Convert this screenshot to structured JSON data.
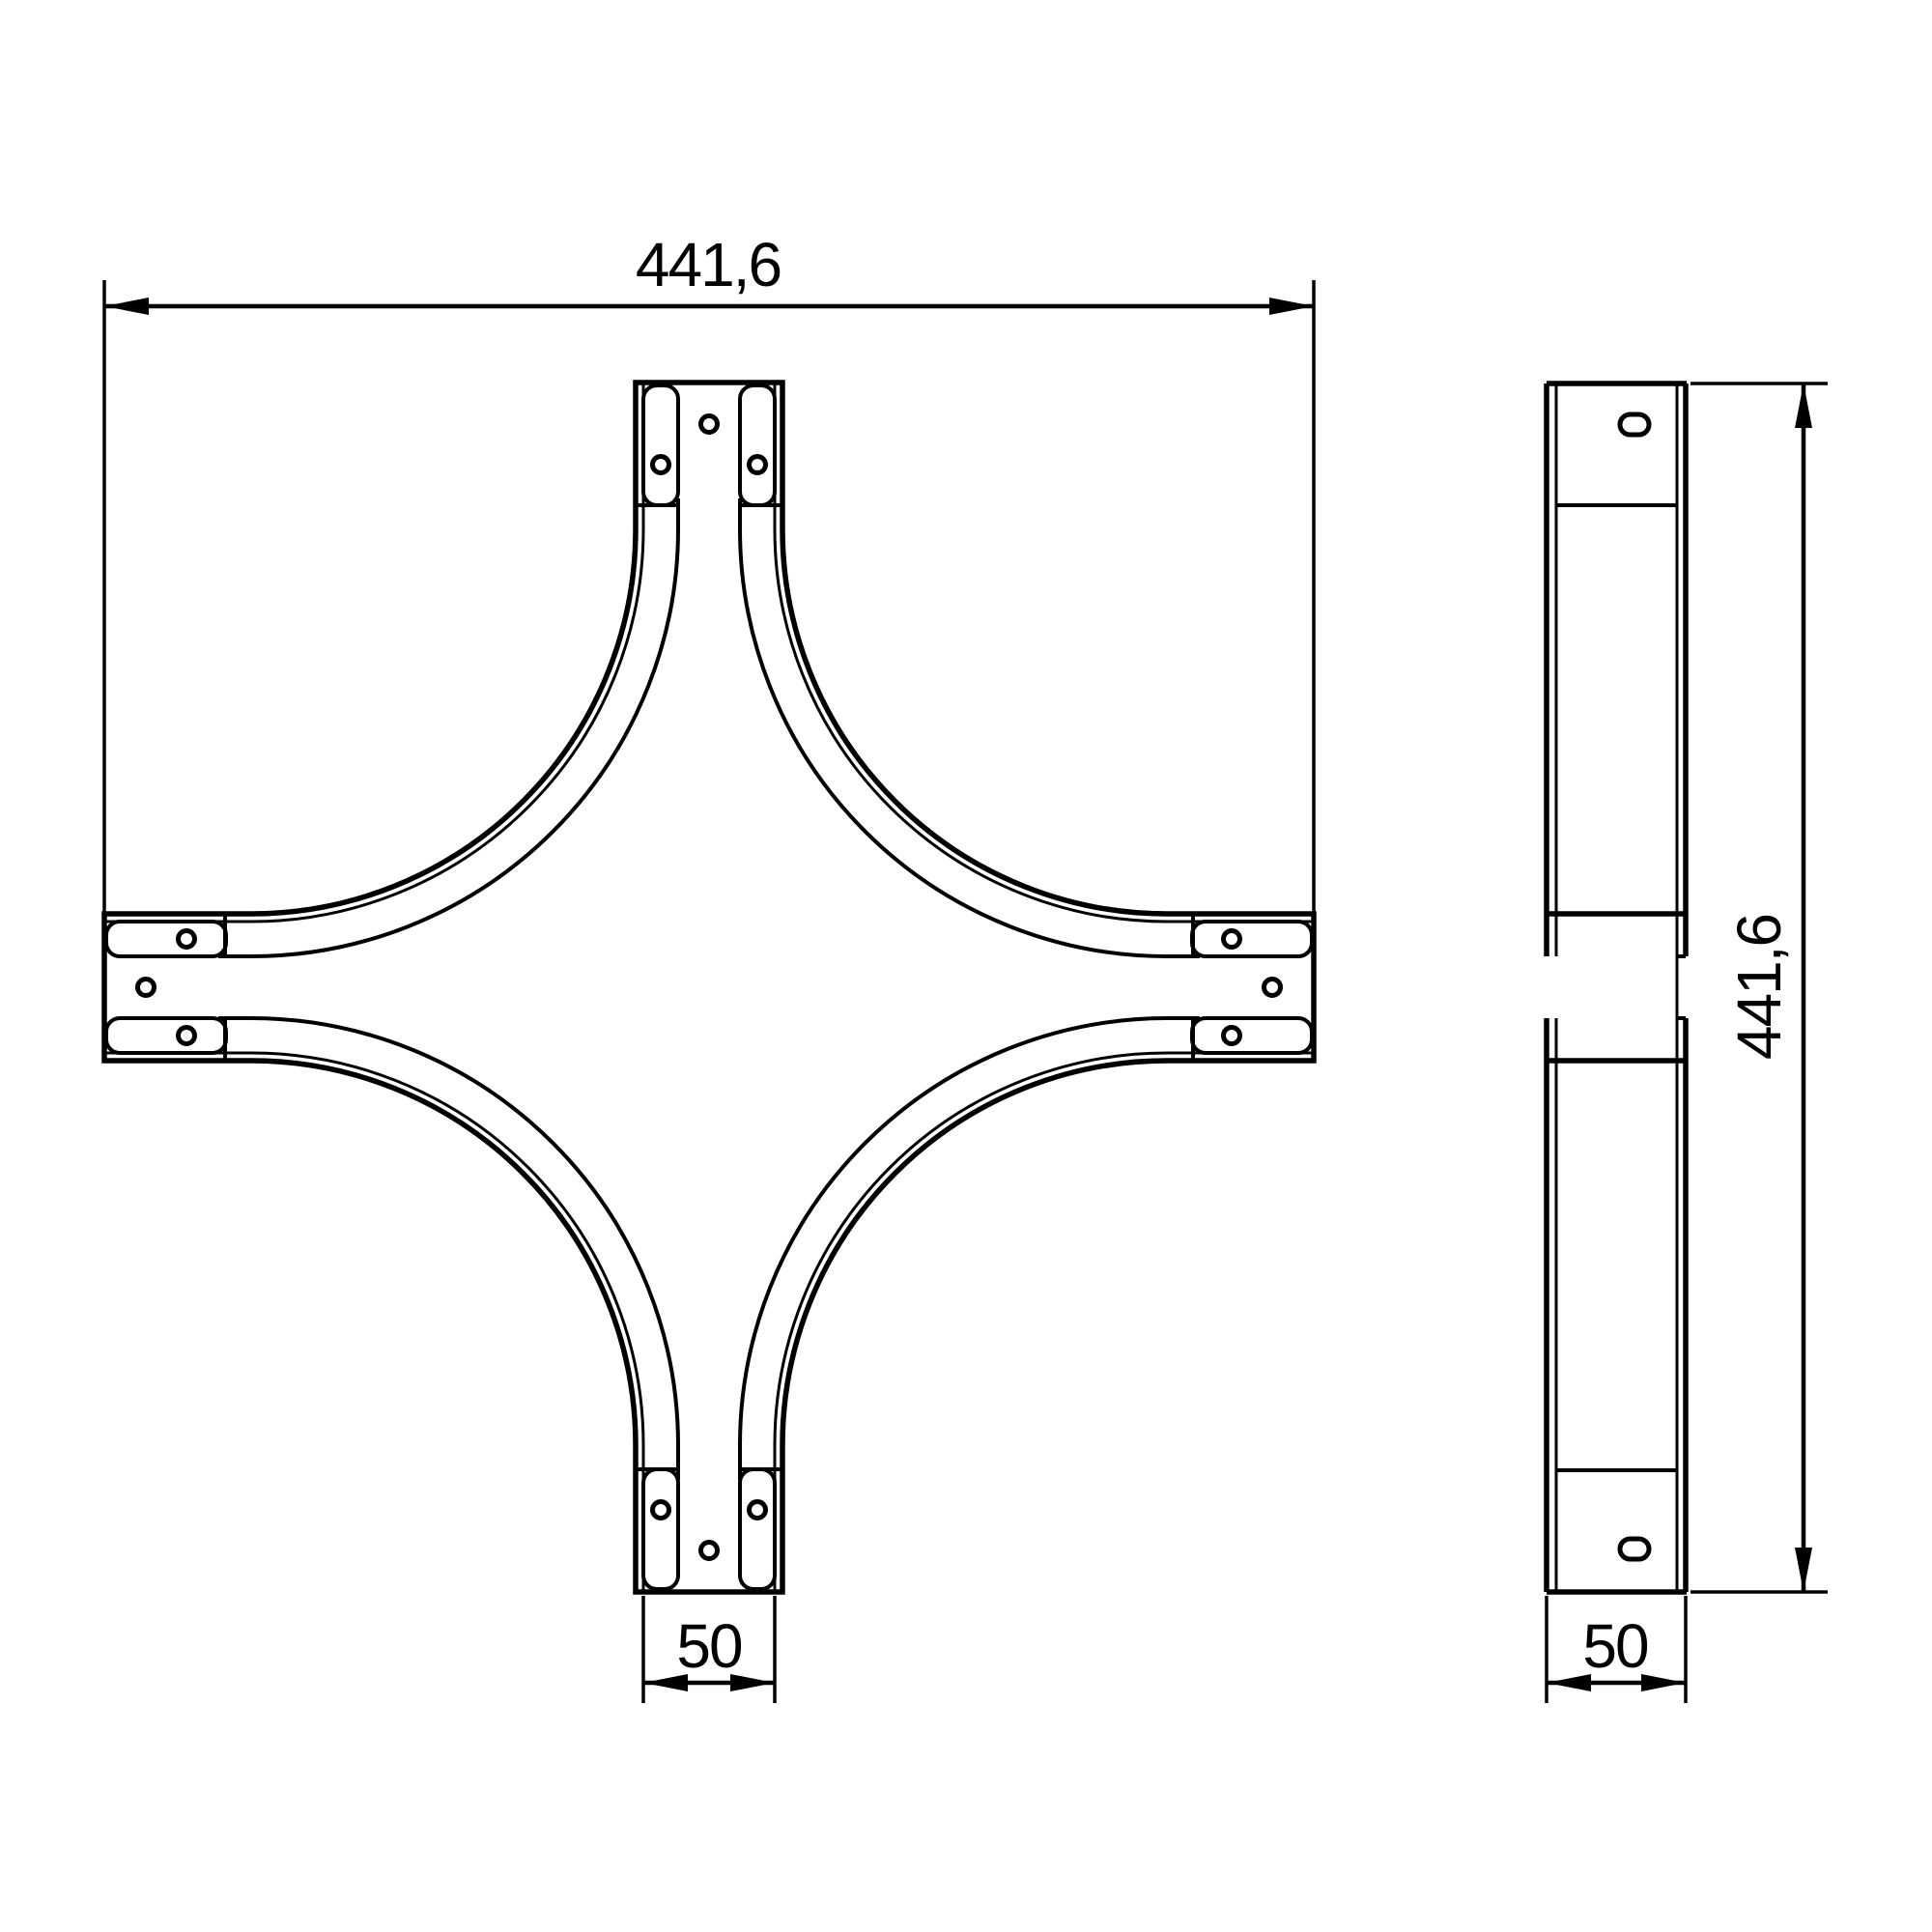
{
  "drawing": {
    "kind": "technical-drawing-cable-tray-cross-piece",
    "views": {
      "plan": "front view of cross piece with four arms, curved fillets, connector tabs and holes",
      "side": "side elevation of channel with slots and crossing-arm break"
    }
  },
  "dimensions": {
    "plan_width": "441,6",
    "plan_arm_width": "50",
    "side_height": "441,6",
    "side_width": "50"
  },
  "colors": {
    "line": "#000000",
    "background": "#ffffff"
  }
}
